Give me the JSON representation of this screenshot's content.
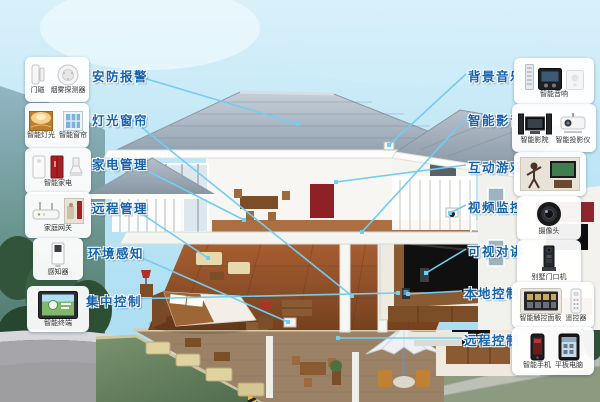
{
  "diagram_title": "smart-home-system-cutaway",
  "colors": {
    "label_text": "#1461ae",
    "connector_line": "#72cdf2",
    "accent_red": "#a51f24",
    "roof_gray": "#a8b6c2",
    "sky_top": "#d9f0fa",
    "sky_bottom": "#a6dbf2"
  },
  "callouts": {
    "left": [
      {
        "label": "安防报警",
        "devices": [
          {
            "icon": "door-magnet",
            "caption": "门磁"
          },
          {
            "icon": "smoke-detector",
            "caption": "烟雾探测器"
          }
        ]
      },
      {
        "label": "灯光窗帘",
        "devices": [
          {
            "icon": "smart-light",
            "caption": "智能灯光"
          },
          {
            "icon": "smart-curtain",
            "caption": "智能窗帘"
          }
        ]
      },
      {
        "label": "家电管理",
        "devices": [
          {
            "icon": "smart-appliances",
            "caption": "智能家电"
          }
        ]
      },
      {
        "label": "远程管理",
        "devices": [
          {
            "icon": "home-gateway",
            "caption": "家庭网关"
          }
        ]
      },
      {
        "label": "环境感知",
        "devices": [
          {
            "icon": "sensor-panel",
            "caption": "感知器"
          }
        ]
      },
      {
        "label": "集中控制",
        "devices": [
          {
            "icon": "smart-terminal",
            "caption": "智能终端"
          }
        ]
      }
    ],
    "right": [
      {
        "label": "背景音乐",
        "devices": [
          {
            "icon": "smart-speaker",
            "caption": "智能音响"
          }
        ]
      },
      {
        "label": "智能影音",
        "devices": [
          {
            "icon": "home-theater",
            "caption": "智能影院"
          },
          {
            "icon": "projector",
            "caption": "智能投影仪"
          }
        ]
      },
      {
        "label": "互动游戏",
        "devices": [
          {
            "icon": "motion-game",
            "caption": ""
          }
        ]
      },
      {
        "label": "视频监控",
        "devices": [
          {
            "icon": "dome-camera",
            "caption": "摄像头"
          }
        ]
      },
      {
        "label": "可视对讲",
        "devices": [
          {
            "icon": "door-station",
            "caption": "别墅门口机"
          }
        ]
      },
      {
        "label": "本地控制",
        "devices": [
          {
            "icon": "touch-panel",
            "caption": "智能触控面板"
          },
          {
            "icon": "remote-control",
            "caption": "遥控器"
          }
        ]
      },
      {
        "label": "远程控制",
        "devices": [
          {
            "icon": "smartphone",
            "caption": "智能手机"
          },
          {
            "icon": "tablet",
            "caption": "平板电脑"
          }
        ]
      }
    ]
  }
}
